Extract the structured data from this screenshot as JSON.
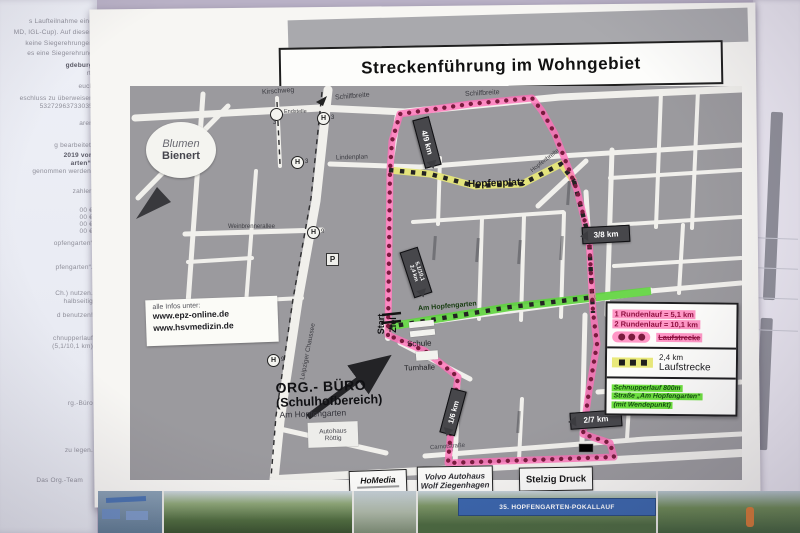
{
  "poster": {
    "title": "Streckenführung im Wohngebiet"
  },
  "map": {
    "streets": {
      "kirschweg": "Kirschweg",
      "schilfbreite": "Schilfbreite",
      "lindenplan": "Lindenplan",
      "weinbrennerallee": "Weinbrennerallee",
      "leipziger_chaussee": "Leipziger Chaussee",
      "am_hopfengarten": "Am Hopfengarten",
      "hopfenbreite": "Hopfenbreite",
      "carnotstrasse": "Carnotstraße"
    },
    "places": {
      "blumen_line1": "Blumen",
      "blumen_line2": "Bienert",
      "hopfenplatz": "Hopfenplatz",
      "endstelle": "Endstelle",
      "schule": "Schule",
      "turnhalle": "Turnhalle",
      "start": "Start",
      "ziel": "Ziel"
    },
    "tram": {
      "h": "H",
      "p": "P",
      "n3": "3",
      "n9": "9"
    },
    "markers": {
      "m49": "4/9 km",
      "m38": "3/8 km",
      "m51a": "5,1/10,1",
      "m51b": "2,4 km",
      "m16": "1/6 km",
      "m27": "2/7 km"
    },
    "info_box": {
      "line1": "alle Infos unter:",
      "line2": "www.epz-online.de",
      "line3": "www.hsvmedizin.de"
    },
    "org": {
      "line1": "ORG.- BÜRO",
      "line2": "(Schulhofbereich)",
      "line3": "Am Hopfengarten"
    },
    "sponsors": {
      "autohaus_line1": "Autohaus",
      "autohaus_line2": "Röttig",
      "homedia": "HoMedia",
      "volvo_line1": "Volvo Autohaus",
      "volvo_line2": "Wolf Ziegenhagen",
      "stelzig": "Stelzig Druck"
    }
  },
  "legend": {
    "round1": "1 Rundenlauf = 5,1 km",
    "round2": "2 Rundenlauf = 10,1 km",
    "laufstrecke1": "Laufstrecke",
    "km24": "2,4 km",
    "laufstrecke2": "Laufstrecke",
    "schnupper1": "Schnupperlauf 800m",
    "schnupper2": "Straße „Am Hopfengarten“",
    "schnupper3": "(mit Wendepunkt)"
  },
  "photo_strip": {
    "banner": "35. HOPFENGARTEN-POKALLAUF"
  },
  "left_sheet": {
    "fragments": [
      "s Laufteilnahme eine",
      "MD, IGL-Cup). Auf diesen",
      "keine Siegerehrungen",
      "es eine Siegerehrung",
      "gdeburg",
      "rt.",
      "euck",
      "eschluss zu überweisen",
      "53272963733035",
      "aren",
      "g bearbeitet!",
      "2019 von",
      "arten“.",
      "genommen werden.",
      "zahlen",
      "00 €",
      "00 €",
      "00 €",
      "00 €",
      "opfengarten“",
      "pfengarten“.",
      "Ch.) nutzen.",
      "halbseitig",
      "d benutzen!",
      "chnupperlauf",
      "(5,1/10,1 km)",
      "rg.-Büro",
      "zu legen.",
      "Das Org.-Team"
    ]
  },
  "colors": {
    "route_pink": "#ff6fb8",
    "route_dot": "#7a1b3e",
    "route_yellow": "#e9e97a",
    "route_green": "#5ed43d",
    "legend_pink": "#ff97c6",
    "legend_green": "#6ee23f",
    "map_gray": "#9b9a9e"
  }
}
